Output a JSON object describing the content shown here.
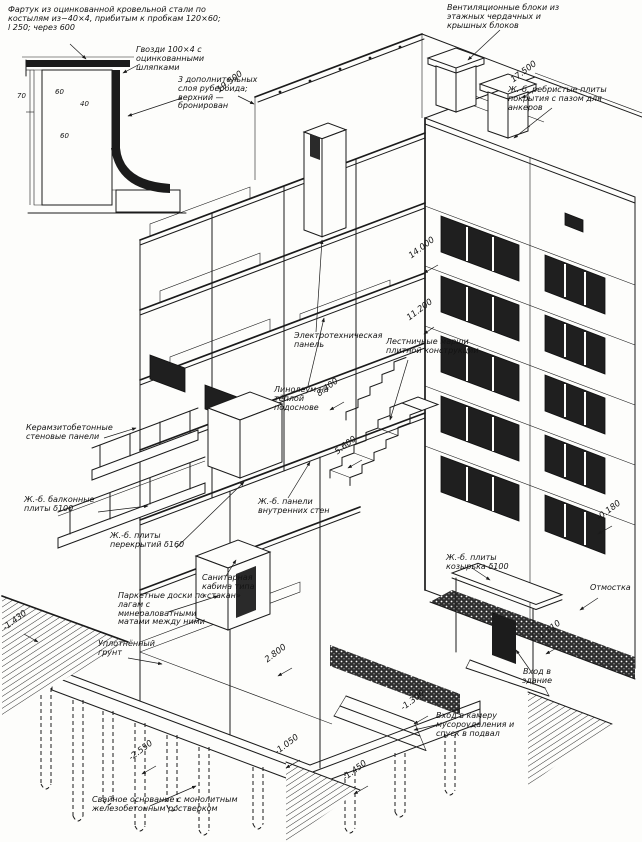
{
  "inset": {
    "note_apron": "Фартук из оцинкованной кровельной стали по костылям из−40×4, прибитым к пробкам 120×60; l 250; через 600",
    "note_nails": "Гвозди 100×4 с оцинкованными шляпками",
    "note_layers": "3 дополнительных слоя рубероида; верхний — бронирован",
    "dim70": "70",
    "dim60a": "60",
    "dim40": "40",
    "dim60b": "60"
  },
  "labels": {
    "vent": "Вентиляционные блоки из этажных чердачных и крышных блоков",
    "ribbed": "Ж.-б. ребристые плиты покрытия с пазом для анкеров",
    "keramzit": "Керамзитобетонные стеновые панели",
    "balcony": "Ж.-б. балконные плиты δ100",
    "floorslab": "Ж.-б. плиты перекрытий δ160",
    "parquet": "Паркетные доски по лагам с минераловатными матами между ними",
    "soil": "Уплотнённый грунт",
    "sancab": "Санитарная кабина типа «стакан»",
    "electro": "Электротехническая панель",
    "stairs": "Лестничные марши плитной конструкции",
    "linoleum": "Линолеум на тёплой подоснове",
    "innerpanels": "Ж.-б. панели внутренних стен",
    "canopy": "Ж.-б. плиты козырька δ100",
    "otmostka": "Отмостка",
    "entrance": "Вход в здание",
    "refuse": "Вход в камеру мусороудаления и спуск в подвал",
    "piles": "Свайное основание с монолитным железобетонным ростверком"
  },
  "elevations": {
    "e19500": "19.500",
    "e17500": "17.500",
    "e14000": "14.000",
    "e11200": "11.200",
    "e8400": "8.400",
    "e5600": "5.600",
    "e2800": "2.800",
    "em0180": "-0.180",
    "em1110": "-1.110",
    "em1300": "-1.300",
    "em1430": "-1.430",
    "em1450": "-1.450",
    "em1050": "-1.050",
    "em2550": "-2.550"
  },
  "colors": {
    "ink": "#1b1b1b",
    "paper": "#fdfdfb"
  }
}
